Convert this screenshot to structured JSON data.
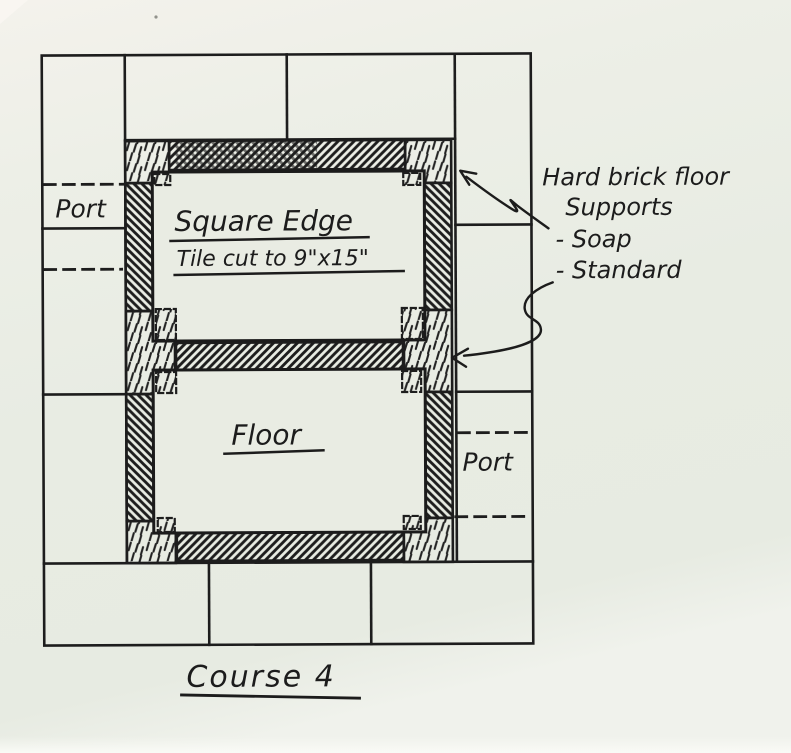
{
  "page": {
    "paper_color": "#eaede4",
    "ink_color": "#1d1d1d"
  },
  "diagram": {
    "caption": "Course 4",
    "upper_chamber": {
      "label_line1": "Square Edge",
      "label_line2": "Tile cut to 9\"x15\""
    },
    "lower_chamber": {
      "label": "Floor"
    },
    "port_left": "Port",
    "port_right": "Port",
    "annotation": {
      "line1": "Hard brick floor",
      "line2": "Supports",
      "items": [
        "- Soap",
        "- Standard"
      ]
    }
  }
}
